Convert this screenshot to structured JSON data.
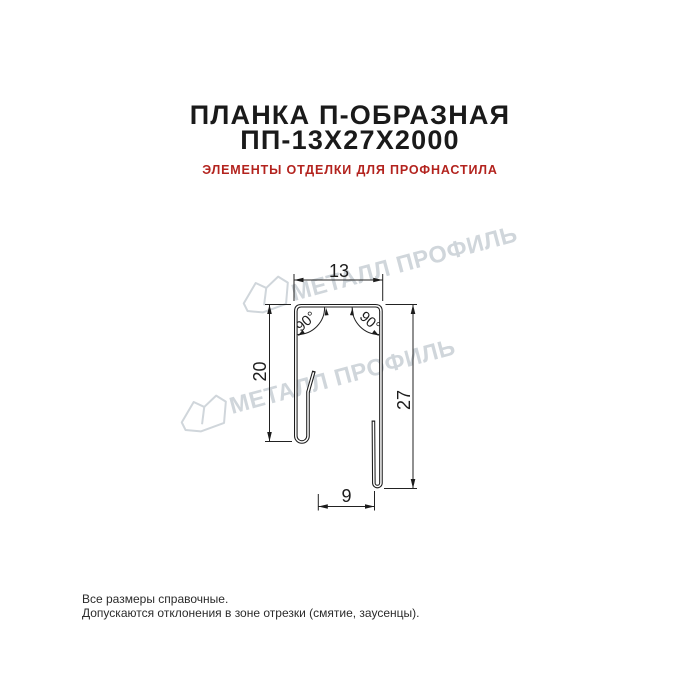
{
  "page": {
    "background": "#ffffff"
  },
  "header": {
    "title_line1": "ПЛАНКА П-ОБРАЗНАЯ",
    "title_line2": "ПП-13Х27Х2000",
    "subtitle": "ЭЛЕМЕНТЫ ОТДЕЛКИ ДЛЯ ПРОФНАСТИЛА",
    "title_color": "#1a1a1a",
    "subtitle_color": "#b3231e"
  },
  "drawing": {
    "type": "technical-cross-section",
    "dimensions": {
      "top_width": "13",
      "left_height": "20",
      "right_height": "27",
      "bottom_width": "9",
      "angle_left": "90°",
      "angle_right": "90°"
    },
    "line_color": "#1c1c1c"
  },
  "watermark": {
    "text": "МЕТАЛЛ ПРОФИЛЬ",
    "color": "#d0d6db",
    "logo": "metall-profil-crystal-logo"
  },
  "footer": {
    "line1": "Все размеры справочные.",
    "line2": "Допускаются отклонения в зоне отрезки (смятие, заусенцы).",
    "color": "#2b2b2b"
  }
}
